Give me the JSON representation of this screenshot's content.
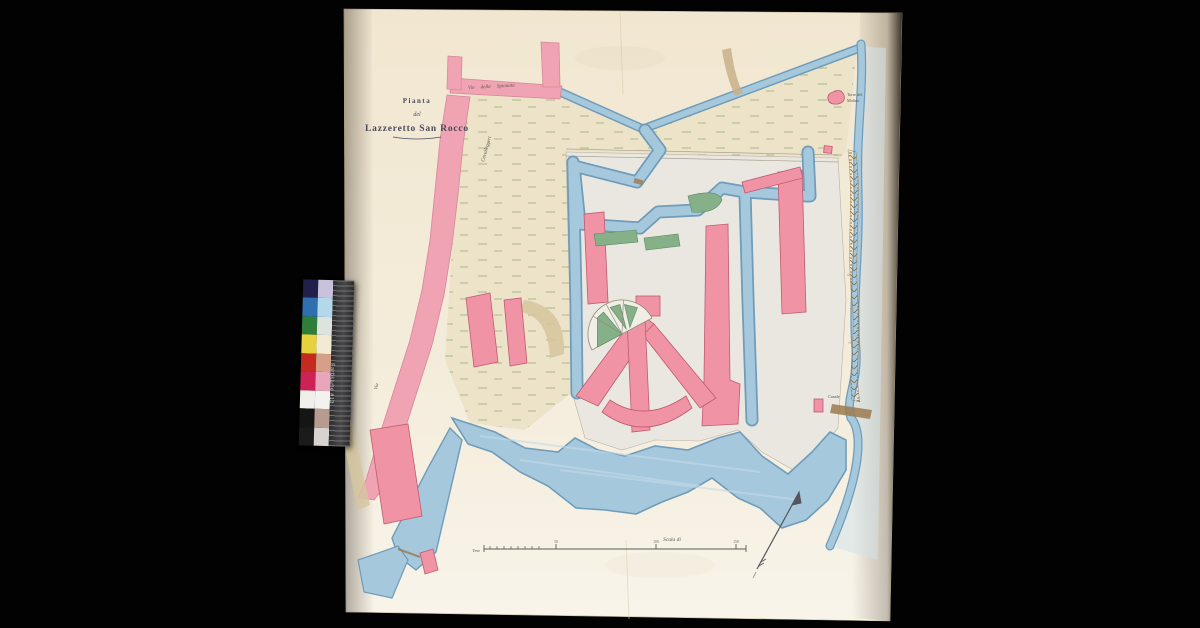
{
  "map": {
    "title": {
      "line1": "Pianta",
      "line2": "del",
      "line3": "Lazzeretto San Rocco"
    },
    "labels": {
      "via_spianata": "Via della Spianata",
      "cavalleggeri": "Cavalleggeri",
      "via": "Via",
      "torre_line1": "Torre del",
      "torre_line2": "Molino",
      "canale": "Canale",
      "sea_letters": [
        "M",
        "a",
        "r",
        "e"
      ],
      "scala": "Scala di",
      "tese": "Tese",
      "ticks": [
        "50",
        "100",
        "150"
      ]
    },
    "colors": {
      "paper": "#f3ead7",
      "water": "#a6c8dc",
      "water_edge": "#6f9cba",
      "building_pink": "#ef93a5",
      "road_pink": "#f0a3b2",
      "land": "#ece3c9",
      "fort_ground": "#eae7e1",
      "garden_green": "#86b088",
      "seawall_brown": "#9c7a4e",
      "ink": "#4a4a5c"
    }
  },
  "calibration": {
    "label": "Farbkarte #13",
    "patches": [
      {
        "left": "#20204a",
        "right": "#c8c2dd"
      },
      {
        "left": "#2f6fb0",
        "right": "#b3d8ea"
      },
      {
        "left": "#2f7d3a",
        "right": "#dfe3df"
      },
      {
        "left": "#e6d23e",
        "right": "#f2ead2"
      },
      {
        "left": "#c32a20",
        "right": "#d5a087"
      },
      {
        "left": "#ce2257",
        "right": "#e7a6bc"
      },
      {
        "left": "#f0efec",
        "right": "#f4f2ee"
      },
      {
        "left": "#151515",
        "right": "#b79a90"
      },
      {
        "left": "#1b1b1b",
        "right": "#d6d3d0"
      }
    ]
  }
}
